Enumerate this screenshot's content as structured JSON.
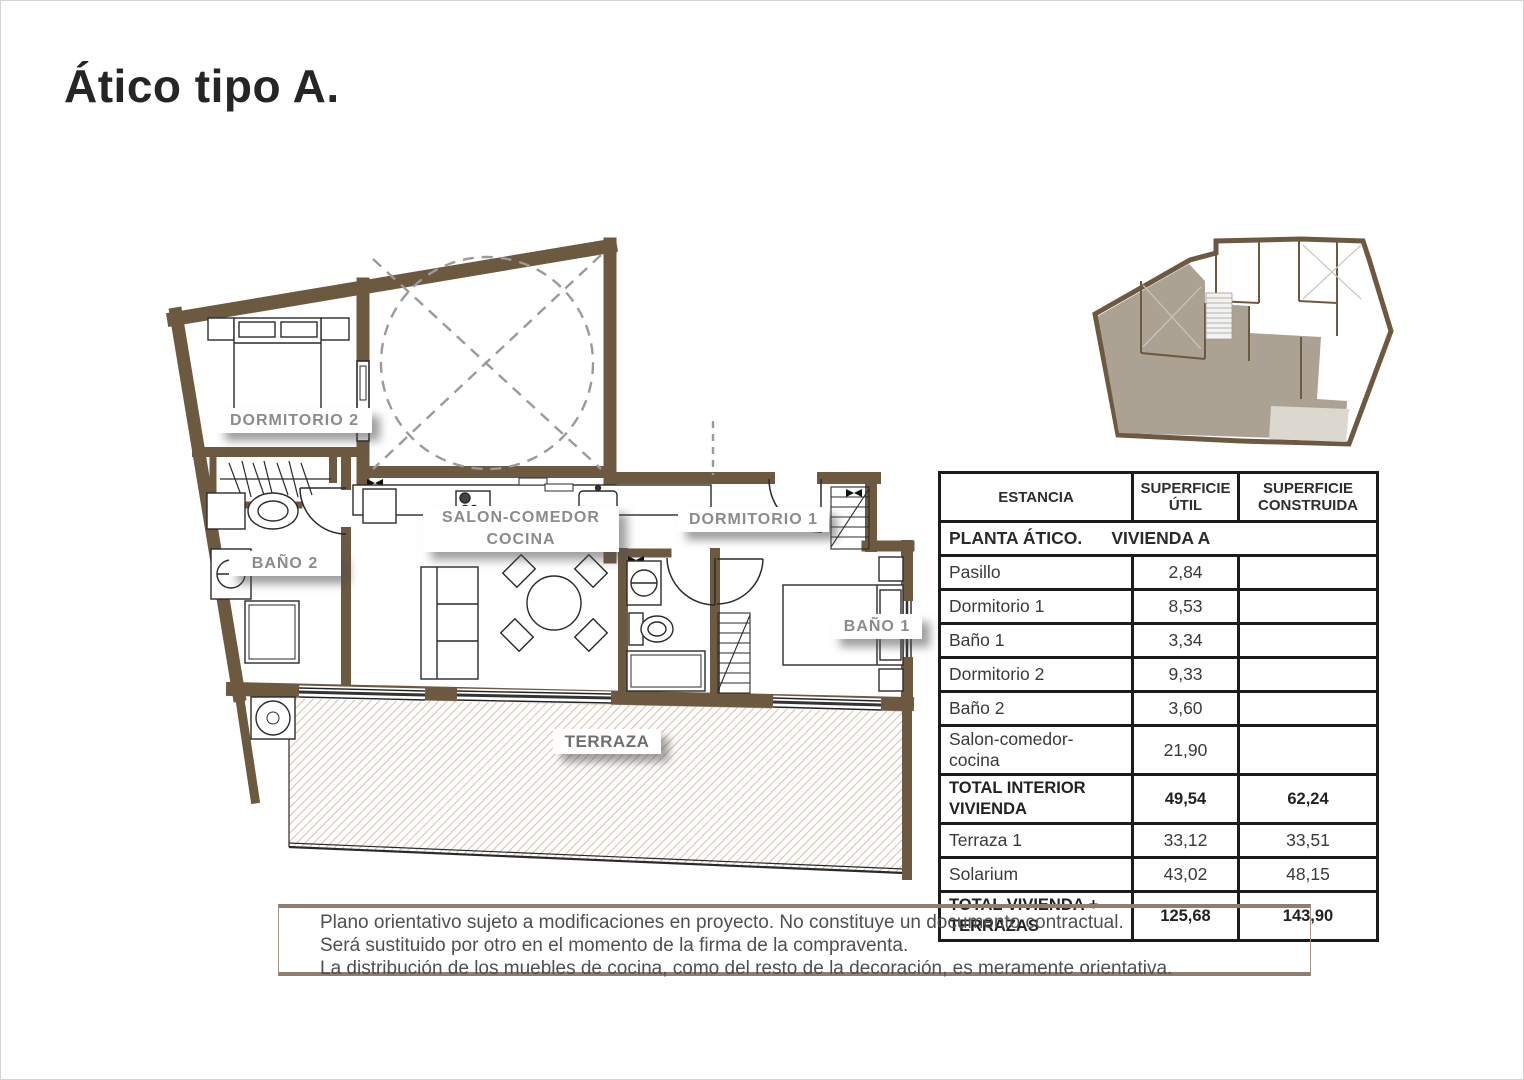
{
  "title": "Ático tipo A.",
  "plan": {
    "labels": {
      "dormitorio2": "DORMITORIO 2",
      "bano2": "BAÑO 2",
      "salon_line1": "SALON-COMEDOR",
      "salon_line2": "COCINA",
      "dormitorio1": "DORMITORIO 1",
      "bano1": "BAÑO 1",
      "terraza": "TERRAZA"
    },
    "colors": {
      "wall": "#6d5940",
      "terrace_hatch": "#c7b299",
      "label_text": "#8b8b8b"
    }
  },
  "minimap": {
    "colors": {
      "wall": "#6d5940",
      "highlight": "#aca294",
      "terrace": "#dcd7cf"
    }
  },
  "table": {
    "headers": [
      "ESTANCIA",
      "SUPERFICIE ÚTIL",
      "SUPERFICIE CONSTRUIDA"
    ],
    "section_title": "PLANTA ÁTICO.      VIVIENDA A",
    "rows": [
      {
        "estancia": "Pasillo",
        "util": "2,84",
        "construida": ""
      },
      {
        "estancia": "Dormitorio 1",
        "util": "8,53",
        "construida": ""
      },
      {
        "estancia": "Baño 1",
        "util": "3,34",
        "construida": ""
      },
      {
        "estancia": "Dormitorio 2",
        "util": "9,33",
        "construida": ""
      },
      {
        "estancia": "Baño 2",
        "util": "3,60",
        "construida": ""
      },
      {
        "estancia": "Salon-comedor-cocina",
        "util": "21,90",
        "construida": ""
      },
      {
        "estancia": "TOTAL INTERIOR VIVIENDA",
        "util": "49,54",
        "construida": "62,24",
        "bold": true
      },
      {
        "estancia": "Terraza 1",
        "util": "33,12",
        "construida": "33,51"
      },
      {
        "estancia": "Solarium",
        "util": "43,02",
        "construida": "48,15"
      },
      {
        "estancia": "TOTAL VIVIENDA + TERRAZAS",
        "util": "125,68",
        "construida": "143,90",
        "bold": true
      }
    ]
  },
  "disclaimer": {
    "lines": [
      "Plano orientativo sujeto a modificaciones en proyecto. No constituye un documento contractual.",
      "Será sustituido por otro en el momento de la firma de la compraventa.",
      "La distribución de los muebles de cocina, como del resto de la decoración, es meramente orientativa."
    ]
  }
}
